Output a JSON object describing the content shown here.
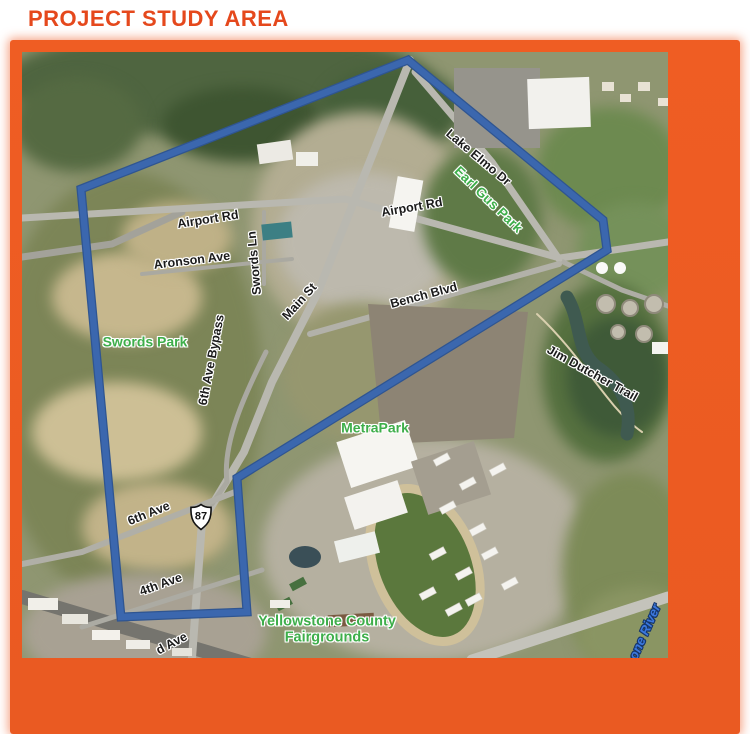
{
  "title": "PROJECT STUDY AREA",
  "colors": {
    "frame_orange": "#EA5A22",
    "title_orange": "#E5481C",
    "boundary_blue": "#3B67AE",
    "park_green": "#3EAE4A",
    "river_blue": "#3B78DE",
    "road_label_black": "#1B1B1B"
  },
  "map": {
    "highway_shield": {
      "number": "87"
    },
    "study_area_boundary": {
      "points": [
        [
          386,
          8
        ],
        [
          581,
          168
        ],
        [
          585,
          198
        ],
        [
          215,
          426
        ],
        [
          225,
          560
        ],
        [
          99,
          565
        ],
        [
          59,
          137
        ]
      ]
    },
    "labels": [
      {
        "text": "Lake Elmo Dr",
        "kind": "road",
        "x": 456,
        "y": 106,
        "rot": 40
      },
      {
        "text": "Earl Gus Park",
        "kind": "park",
        "x": 466,
        "y": 148,
        "rot": 44
      },
      {
        "text": "Airport Rd",
        "kind": "road",
        "x": 390,
        "y": 156,
        "rot": -10
      },
      {
        "text": "Airport Rd",
        "kind": "road",
        "x": 186,
        "y": 168,
        "rot": -9
      },
      {
        "text": "Aronson Ave",
        "kind": "road",
        "x": 170,
        "y": 209,
        "rot": -7
      },
      {
        "text": "Swords Ln",
        "kind": "road",
        "x": 233,
        "y": 211,
        "rot": -95
      },
      {
        "text": "Main St",
        "kind": "road",
        "x": 278,
        "y": 250,
        "rot": -48
      },
      {
        "text": "Bench Blvd",
        "kind": "road",
        "x": 402,
        "y": 244,
        "rot": -15
      },
      {
        "text": "Swords Park",
        "kind": "park",
        "x": 123,
        "y": 290,
        "rot": 0,
        "size": 14
      },
      {
        "text": "6th Ave Bypass",
        "kind": "road",
        "x": 190,
        "y": 308,
        "rot": -79
      },
      {
        "text": "Jim Dutcher Trail",
        "kind": "road",
        "x": 570,
        "y": 322,
        "rot": 29
      },
      {
        "text": "MetraPark",
        "kind": "park",
        "x": 353,
        "y": 376,
        "rot": 0,
        "size": 14
      },
      {
        "text": "6th Ave",
        "kind": "road",
        "x": 127,
        "y": 462,
        "rot": -22
      },
      {
        "text": "4th Ave",
        "kind": "road",
        "x": 139,
        "y": 533,
        "rot": -20
      },
      {
        "text": "d Ave",
        "kind": "road",
        "x": 150,
        "y": 592,
        "rot": -28
      },
      {
        "lines": [
          "Yellowstone County",
          "Fairgrounds"
        ],
        "kind": "park",
        "x": 305,
        "y": 578,
        "rot": 0,
        "size": 14.5
      },
      {
        "text": "one River",
        "kind": "river",
        "x": 623,
        "y": 580,
        "rot": -66
      }
    ]
  }
}
